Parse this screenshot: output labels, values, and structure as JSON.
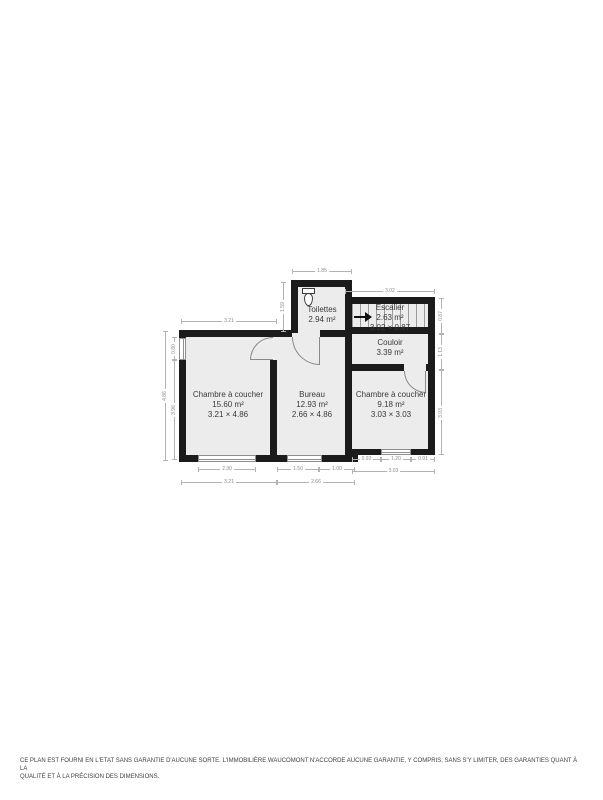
{
  "page": {
    "background": "#ffffff",
    "disclaimer_line1": "CE PLAN EST FOURNI EN L'ETAT SANS GARANTIE D'AUCUNE SORTE. L'IMMOBILIÈRE WAUCOMONT N'ACCORDE AUCUNE GARANTIE, Y COMPRIS, SANS S'Y LIMITER, DES GARANTIES QUANT À LA",
    "disclaimer_line2": "QUALITÉ ET À LA PRÉCISION DES DIMENSIONS."
  },
  "floorplan": {
    "colors": {
      "wall": "#1b1b1b",
      "floor": "#ececec",
      "dimension": "#8a8a8a",
      "label": "#3a3a3a"
    },
    "rooms": {
      "toilettes": {
        "name": "Toilettes",
        "area": "2.94 m²"
      },
      "escalier": {
        "name": "Escalier",
        "area": "2.63 m²",
        "dims": "3.02 × 0.87"
      },
      "couloir": {
        "name": "Couloir",
        "area": "3.39 m²"
      },
      "chambre1": {
        "name": "Chambre à coucher",
        "area": "15.60 m²",
        "dims": "3.21 × 4.86"
      },
      "bureau": {
        "name": "Bureau",
        "area": "12.93 m²",
        "dims": "2.66 × 4.86"
      },
      "chambre2": {
        "name": "Chambre à coucher",
        "area": "9.18 m²",
        "dims": "3.03 × 3.03"
      }
    },
    "dimensions": {
      "top_toilettes": "1.85",
      "top_escalier": "3.02",
      "top_chambre1": "3.21",
      "left_toilettes": "1.59",
      "left_window": "0.80",
      "left_lower": "3.96",
      "left_total": "4.86",
      "right_escalier": "0.87",
      "right_couloir": "1.13",
      "right_chambre": "3.03",
      "bottom_ch1_window": "2.30",
      "bottom_ch1_total": "3.21",
      "bottom_bureau_a": "1.50",
      "bottom_bureau_b": "1.00",
      "bottom_bureau_total": "2.66",
      "bottom_ch2_a": "0.92",
      "bottom_ch2_b": "1.20",
      "bottom_ch2_c": "0.91",
      "bottom_ch2_total": "3.03"
    }
  }
}
